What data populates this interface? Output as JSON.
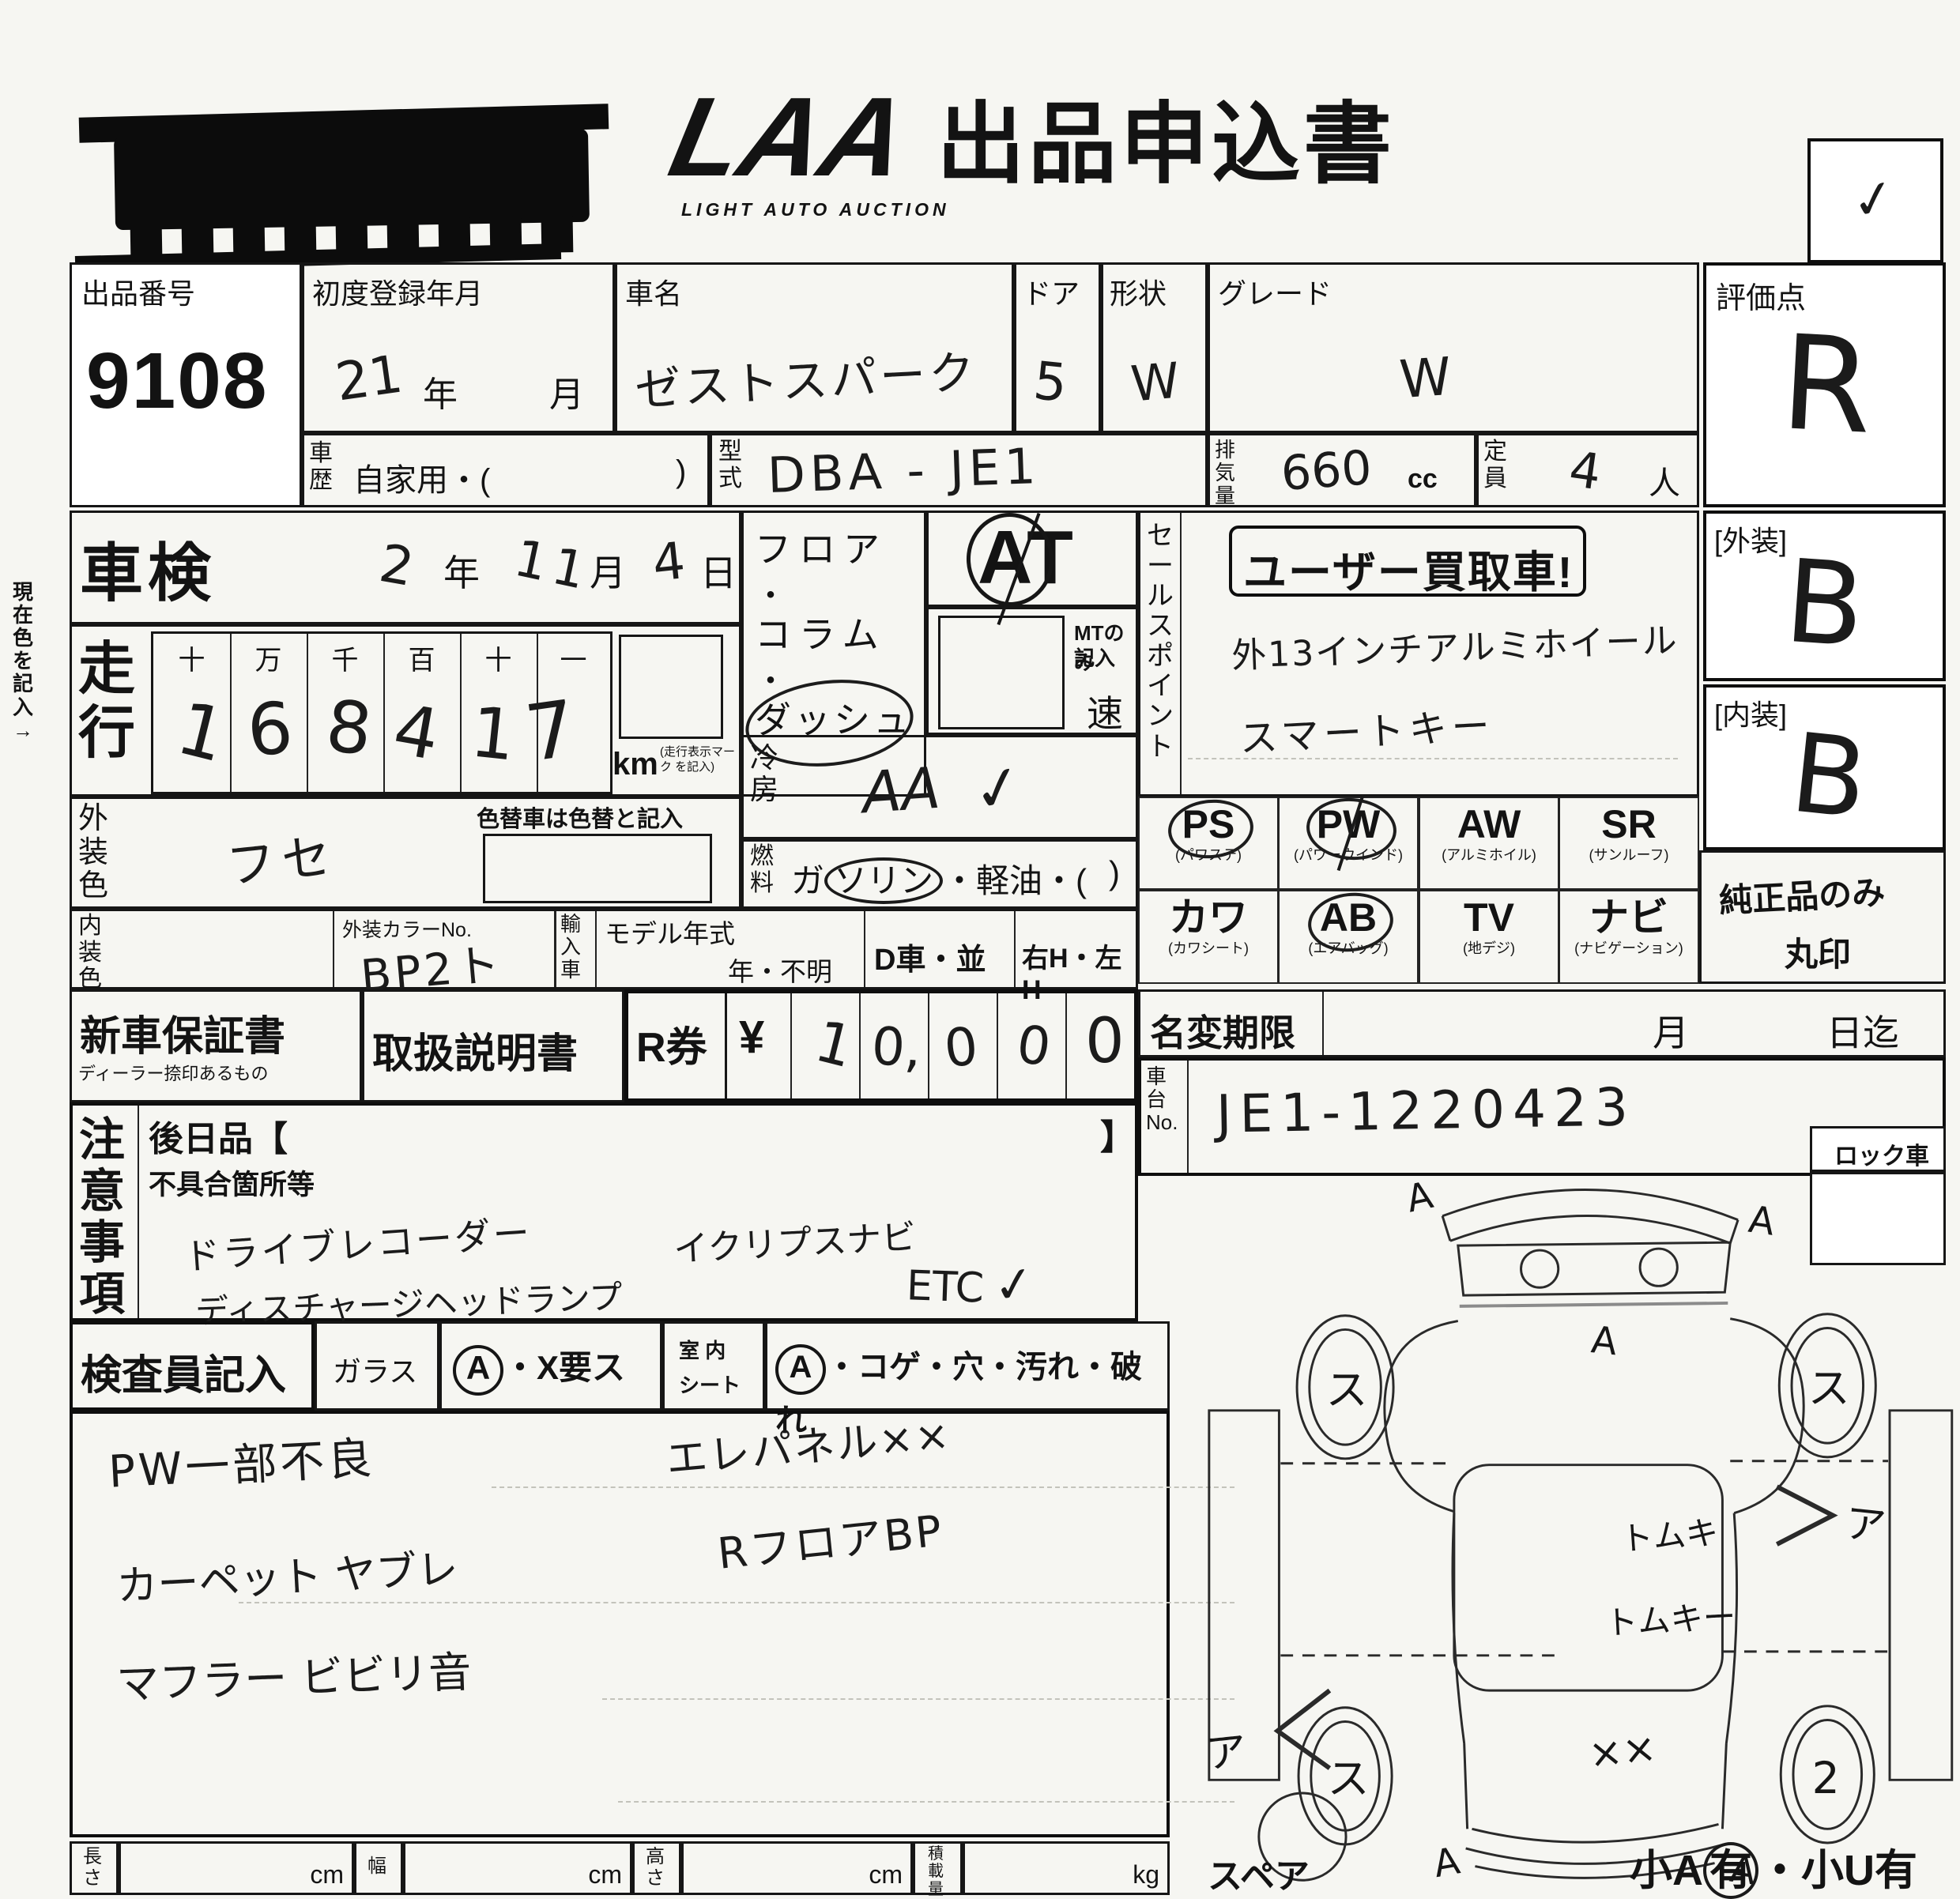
{
  "header": {
    "logo_text": "LAA",
    "logo_subtext": "LIGHT AUTO AUCTION",
    "title": "出品申込書",
    "checkbox_mark": "✓"
  },
  "side_note": "現在色を記入→",
  "lot": {
    "label": "出品番号",
    "number": "9108"
  },
  "first_registration": {
    "label": "初度登録年月",
    "year_value": "21",
    "year_unit": "年",
    "month_unit": "月"
  },
  "car_name": {
    "label": "車名",
    "value": "ゼストスパーク"
  },
  "doors": {
    "label": "ドア",
    "value": "5"
  },
  "body_shape": {
    "label": "形状",
    "value": "W"
  },
  "grade": {
    "label": "グレード",
    "value": "W"
  },
  "score": {
    "label": "評価点",
    "value": "R"
  },
  "history": {
    "label": "車歴",
    "value": "自家用・(",
    "close": ")"
  },
  "model_code": {
    "label": "型式",
    "value": "DBA - JE1"
  },
  "displacement": {
    "label": "排気量",
    "value": "660",
    "unit": "cc"
  },
  "capacity": {
    "label": "定員",
    "value": "4",
    "unit": "人"
  },
  "shaken": {
    "label": "車検",
    "year_value": "2",
    "year_unit": "年",
    "month_value": "11",
    "month_unit": "月",
    "day_value": "4",
    "day_unit": "日"
  },
  "odometer": {
    "label": "走行",
    "column_headers": [
      "十",
      "万",
      "千",
      "百",
      "十",
      "一"
    ],
    "digits": [
      "1",
      "6",
      "8",
      "4",
      "1",
      "7"
    ],
    "unit": "km",
    "unit_note": "(走行表示マーク を記入)"
  },
  "exterior_color": {
    "label": "外装色",
    "value": "フセ",
    "recolor_note": "色替車は色替と記入"
  },
  "interior_color_row": {
    "label": "内装色",
    "color_no_label": "外装カラーNo.",
    "color_no_value": "BP2ト",
    "import_label": "輸入車",
    "model_year_label": "モデル年式",
    "model_year_value": "年・不明",
    "d_car": "D車・並",
    "handle": "右H・左H"
  },
  "shift": {
    "floor": "フロア",
    "dot1": "・",
    "column": "コラム",
    "dot2": "・",
    "dash": "ダッシュ",
    "at": "AT",
    "mt_note_1": "MTのみ",
    "mt_note_2": "記入",
    "speed_unit": "速"
  },
  "aircon": {
    "label": "冷房",
    "value": "AA",
    "check": "✓"
  },
  "fuel": {
    "label": "燃料",
    "pre": "ガ",
    "circled": "ソリン",
    "post": "・軽油・(",
    "close": ")"
  },
  "sales_point": {
    "label": "セールスポイント",
    "stamp": "ユーザー買取車!",
    "line1": "外13インチアルミホイール",
    "line2": "スマートキー"
  },
  "exterior_score": {
    "label": "[外装]",
    "value": "B"
  },
  "interior_score": {
    "label": "[内装]",
    "value": "B"
  },
  "options": {
    "row1": [
      {
        "code": "PS",
        "name": "(パワステ)",
        "circled": true
      },
      {
        "code": "PW",
        "name": "(パワーウインド)",
        "circled": true
      },
      {
        "code": "AW",
        "name": "(アルミホイル)",
        "circled": false
      },
      {
        "code": "SR",
        "name": "(サンルーフ)",
        "circled": false
      }
    ],
    "row2": [
      {
        "code": "カワ",
        "name": "(カワシート)",
        "circled": false
      },
      {
        "code": "AB",
        "name": "(エアバッグ)",
        "circled": true
      },
      {
        "code": "TV",
        "name": "(地デジ)",
        "circled": false
      },
      {
        "code": "ナビ",
        "name": "(ナビゲーション)",
        "circled": false
      }
    ],
    "genuine_line1": "純正品のみ",
    "genuine_line2": "丸印"
  },
  "warranty": {
    "label": "新車保証書",
    "sublabel": "ディーラー捺印あるもの"
  },
  "manual_label": "取扱説明書",
  "r_ticket": {
    "label": "R券",
    "currency": "¥",
    "digits": [
      "1",
      "0,",
      "0",
      "0",
      "0"
    ]
  },
  "name_change": {
    "label": "名変期限",
    "month_unit": "月",
    "until": "日迄"
  },
  "chassis": {
    "label": "車台No.",
    "value": "JE1-1220423"
  },
  "notes": {
    "label": "注意事項",
    "later_label": "後日品【",
    "later_close": "】",
    "defect_label": "不具合箇所等",
    "hand1": "ドライブレコーダー",
    "hand2": "イクリプスナビ",
    "hand3": "ディスチャージヘッドランプ",
    "hand4": "ETC",
    "hand4_check": "✓"
  },
  "lock_car_label": "ロック車",
  "inspector": {
    "label": "検査員記入",
    "glass_label": "ガラス",
    "glass_a": "A",
    "glass_rest": "・X要ス",
    "seat_line1": "室 内",
    "seat_line2": "シート",
    "seat_a": "A",
    "seat_rest": "・コゲ・穴・汚れ・破れ",
    "hand1": "PW一部不良",
    "hand2": "エレパネル××",
    "hand3": "カーペット ヤブレ",
    "hand4": "RフロアBP",
    "hand5": "マフラー ビビリ音"
  },
  "measurements": {
    "length_label": "長さ",
    "width_label": "幅",
    "height_label": "高さ",
    "load_label": "積載量",
    "cm": "cm",
    "kg": "kg"
  },
  "diagram": {
    "spare_label": "スペア",
    "note_pre": "小A",
    "note_circled": "有",
    "note_mid": "・",
    "note_post": "小U有",
    "front_left": "A",
    "front_right": "A",
    "hood": "A",
    "front_wheel_left": "ス",
    "front_wheel_right": "ス",
    "side_left": "ア",
    "side_right": "ア",
    "center_1": "トムキ",
    "center_2": "トムキー",
    "rear_x": "××",
    "rear_wheel_left": "ス",
    "rear_wheel_right": "2",
    "rear_left": "A",
    "rear_right": "A"
  }
}
